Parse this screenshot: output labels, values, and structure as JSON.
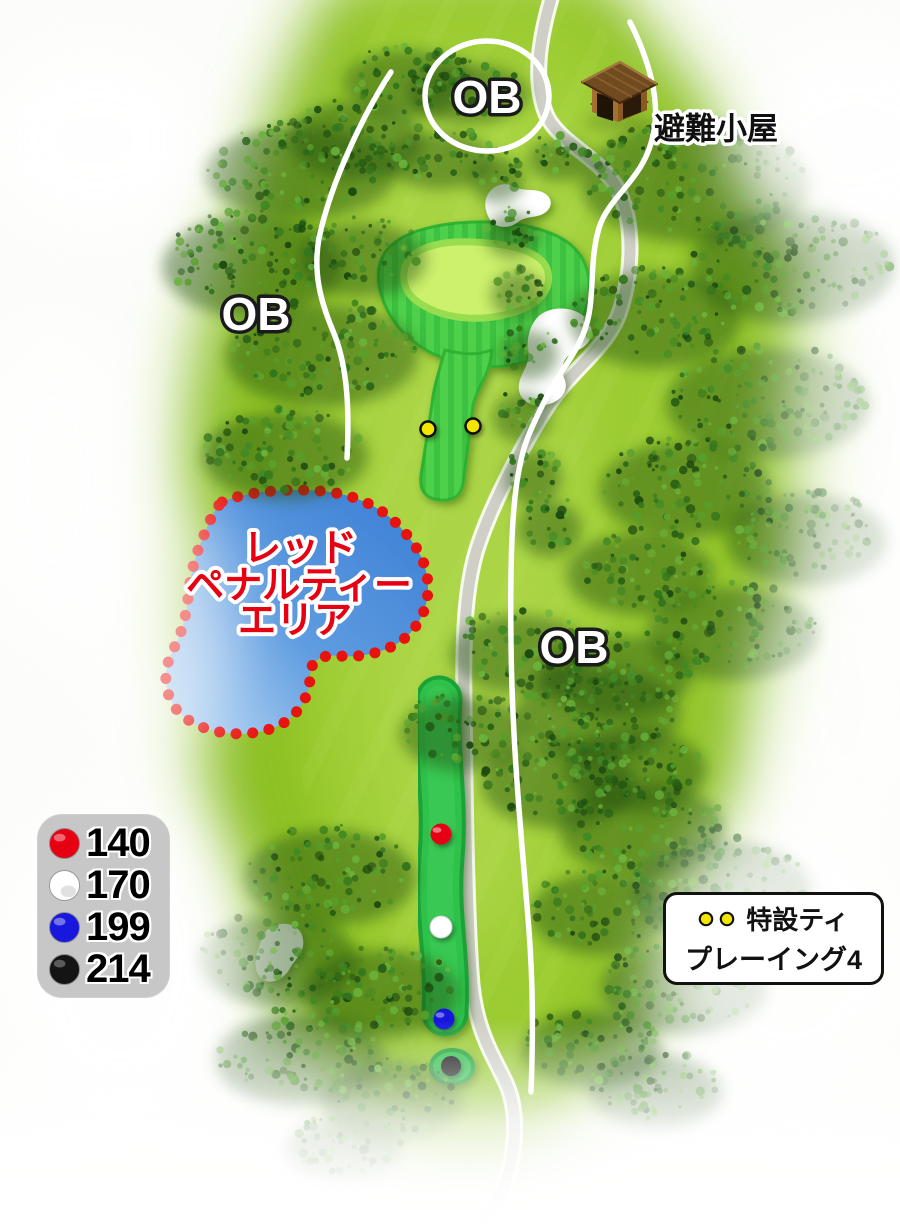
{
  "labels": {
    "ob_top": "OB",
    "ob_left": "OB",
    "ob_right": "OB",
    "hut": "避難小屋"
  },
  "penalty_area": {
    "line1": "レッド",
    "line2": "ペナルティー",
    "line3": "エリア",
    "text_color": "#e60012",
    "border_color": "#e8120e",
    "water_color": "#3f82d6"
  },
  "legend": {
    "items": [
      {
        "name": "red-tee",
        "color": "#e60012",
        "value": "140"
      },
      {
        "name": "white-tee",
        "color": "#ffffff",
        "value": "170"
      },
      {
        "name": "blue-tee",
        "color": "#1717dd",
        "value": "199"
      },
      {
        "name": "black-tee",
        "color": "#141414",
        "value": "214"
      }
    ]
  },
  "special_tee": {
    "label": "特設ティ",
    "sub_label": "プレーイング4",
    "dot_color": "#f2e600"
  },
  "course": {
    "green_collar_color": "#4fd04b",
    "green_surface_color": "#cdf06d",
    "fairway_strip_color": "#2fc24c",
    "path_color": "#cfcfc7"
  }
}
